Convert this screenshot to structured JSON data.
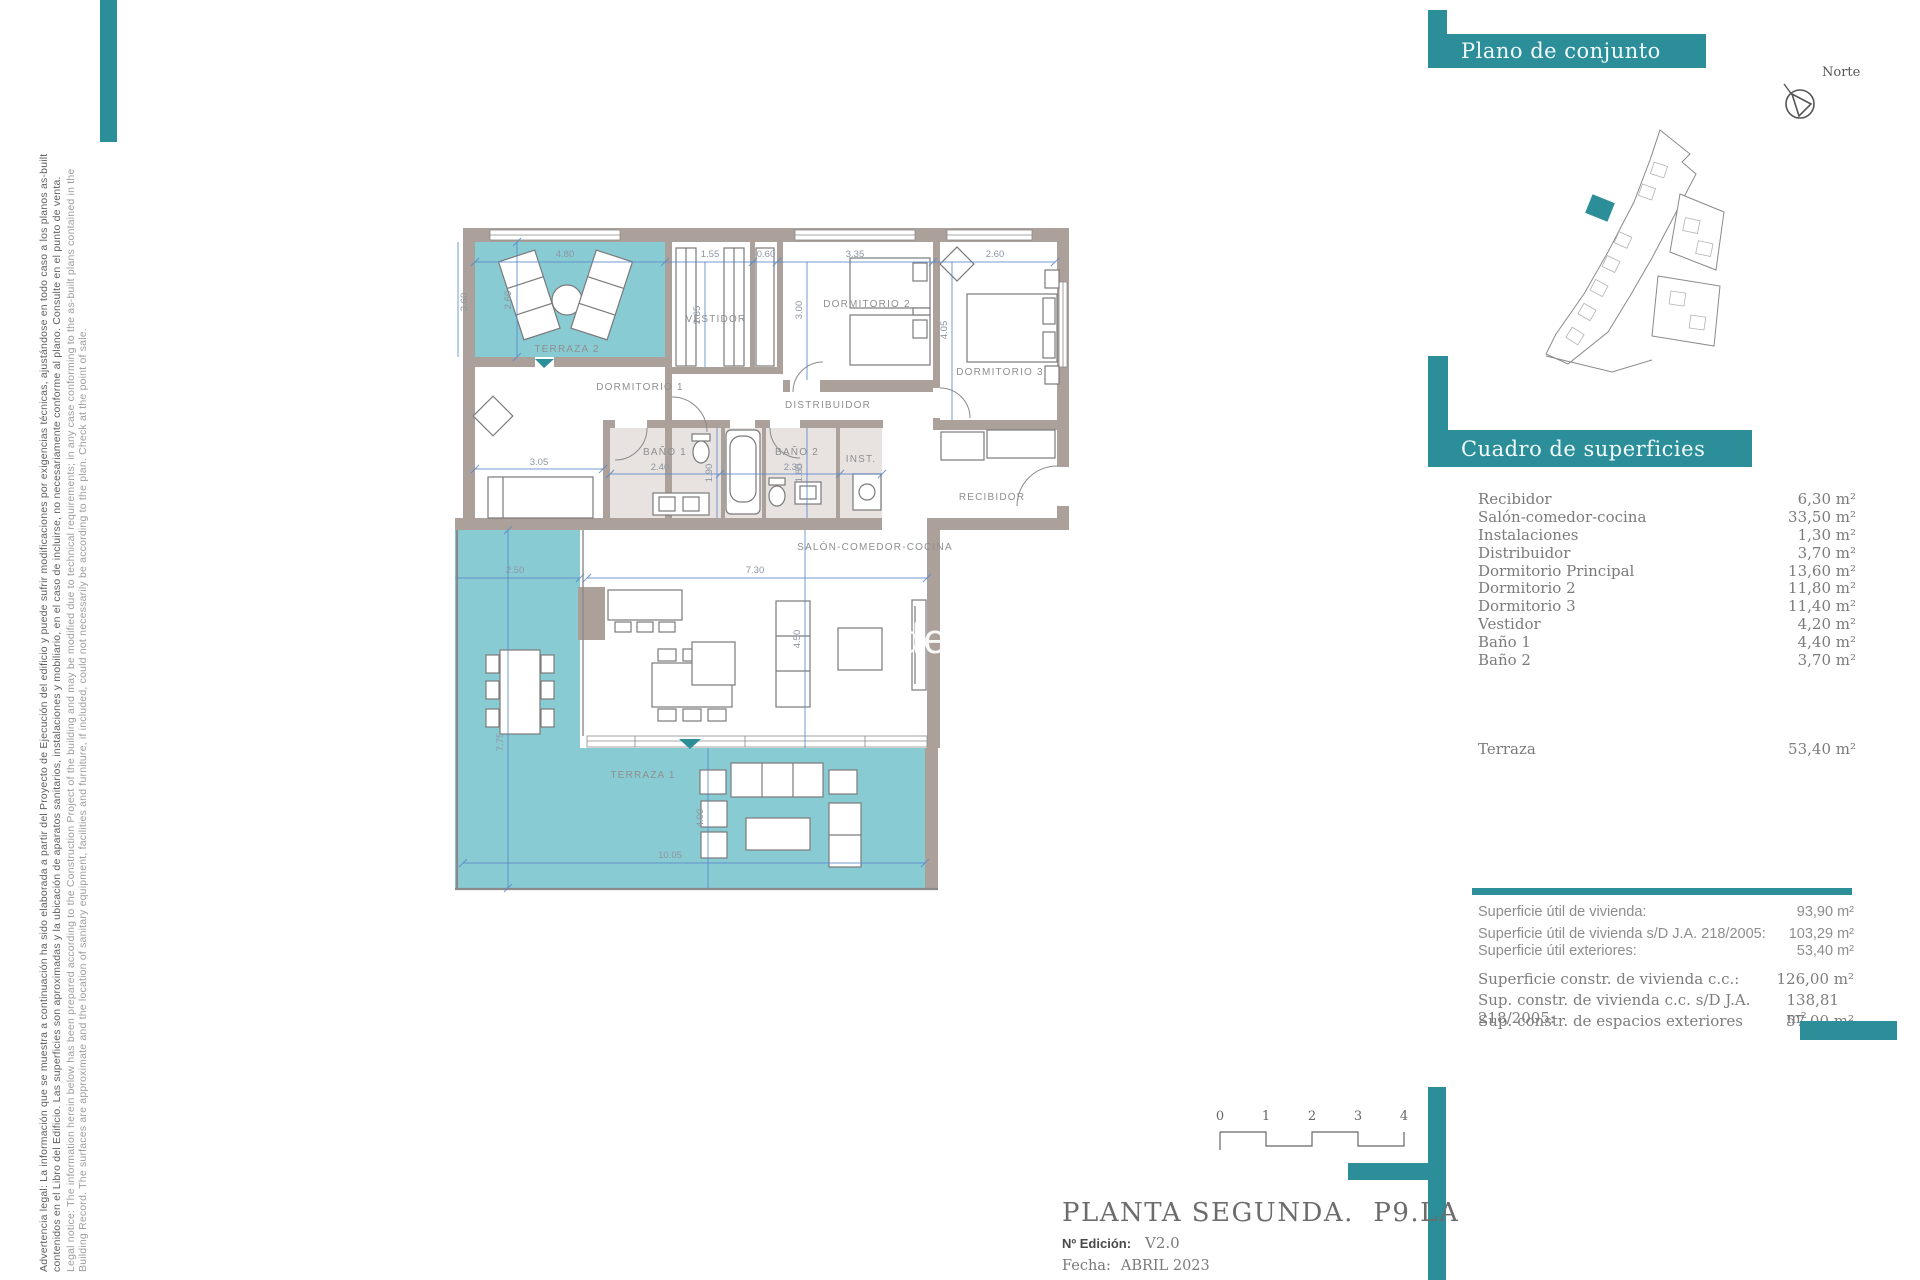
{
  "colors": {
    "accent_teal": "#2b8e99",
    "terrace_fill": "#89cbd2",
    "wall": "#aba19a",
    "dimension_blue": "#5b86c9",
    "bath_floor": "#e8e3e0"
  },
  "legal": {
    "es1": "Advertencia legal: La información que se muestra a continuación ha sido elaborada a partir del Proyecto de Ejecución del edificio y puede sufrir modificaciones por exigencias técnicas, ajustándose en todo caso a los planos as-built",
    "es2": "contenidos en el Libro del Edificio. Las superficies son aproximadas y la ubicación de aparatos sanitarios, instalaciones y mobiliario, en el caso de incluirse, no necesariamente conforme al plano. Consulte en el punto de venta.",
    "en1": "Legal notice: The information herein below has been prepared according to the Construction Project of the building and may be modified due to technical requirements; in any case conforming to the as-built plans contained in the",
    "en2": "Building Record. The surfaces are approximate and the location of sanitary equipment, facilities and furniture, if included, could not necessarily be according to the plan. Check at the point of sale."
  },
  "overview": {
    "title": "Plano de conjunto",
    "north": "Norte"
  },
  "surfaces": {
    "title": "Cuadro de superficies",
    "rows": [
      {
        "label": "Recibidor",
        "value": "6,30 m²"
      },
      {
        "label": "Salón-comedor-cocina",
        "value": "33,50 m²"
      },
      {
        "label": "Instalaciones",
        "value": "1,30 m²"
      },
      {
        "label": "Distribuidor",
        "value": "3,70 m²"
      },
      {
        "label": "Dormitorio Principal",
        "value": "13,60 m²"
      },
      {
        "label": "Dormitorio 2",
        "value": "11,80 m²"
      },
      {
        "label": "Dormitorio 3",
        "value": "11,40 m²"
      },
      {
        "label": "Vestidor",
        "value": "4,20 m²"
      },
      {
        "label": "Baño 1",
        "value": "4,40 m²"
      },
      {
        "label": "Baño 2",
        "value": "3,70 m²"
      }
    ],
    "terraza": {
      "label": "Terraza",
      "value": "53,40 m²"
    }
  },
  "totals": {
    "group1": [
      {
        "label": "Superficie útil de vivienda:",
        "value": "93,90 m²"
      },
      {
        "label": "Superficie útil de vivienda s/D J.A. 218/2005:",
        "value": "103,29 m²"
      },
      {
        "label": "Superficie útil exteriores:",
        "value": "53,40 m²"
      }
    ],
    "group2": [
      {
        "label": "Superficie constr. de vivienda c.c.:",
        "value": "126,00 m²"
      },
      {
        "label": "Sup. constr. de vivienda c.c. s/D J.A. 218/2005:",
        "value": "138,81 m²"
      },
      {
        "label": "Sup. constr. de espacios exteriores",
        "value": "57,00 m²"
      }
    ]
  },
  "title_block": {
    "title": "PLANTA SEGUNDA.  P9.LA",
    "edition_label": "Nº Edición:",
    "edition_value": "V2.0",
    "date_label": "Fecha:",
    "date_value": "ABRIL 2023"
  },
  "scale": {
    "t0": "0",
    "t1": "1",
    "t2": "2",
    "t3": "3",
    "t4": "4"
  },
  "plan": {
    "labels": {
      "terraza2": "TERRAZA 2",
      "dorm1": "DORMITORIO 1",
      "vestidor": "VESTIDOR",
      "dorm2": "DORMITORIO 2",
      "dorm3": "DORMITORIO 3",
      "distribuidor": "DISTRIBUIDOR",
      "bano1": "BAÑO 1",
      "bano2": "BAÑO 2",
      "inst": "INST.",
      "recibidor": "RECIBIDOR",
      "salon": "SALÓN-COMEDOR-COCINA",
      "terraza1": "TERRAZA 1"
    },
    "dims": {
      "t2_w": "4.80",
      "t2_h": "2.60",
      "left_h": "3.60",
      "vest_w": "1.55",
      "closet_w": "0.60",
      "vest_h": "2.65",
      "d2_w": "3.35",
      "d2_h": "3.00",
      "d3_w": "2.60",
      "d3_h": "4.05",
      "d1_w": "3.05",
      "b1_w": "2.40",
      "b1_h": "1.90",
      "b2_w": "2.30",
      "b2_h": "1.80",
      "salon_w": "7.30",
      "salon_h": "4.50",
      "t1_w": "2.50",
      "t1_h": "7.75",
      "t1_bw": "10.05",
      "t1_bh": "4.00"
    },
    "watermark": "de"
  }
}
